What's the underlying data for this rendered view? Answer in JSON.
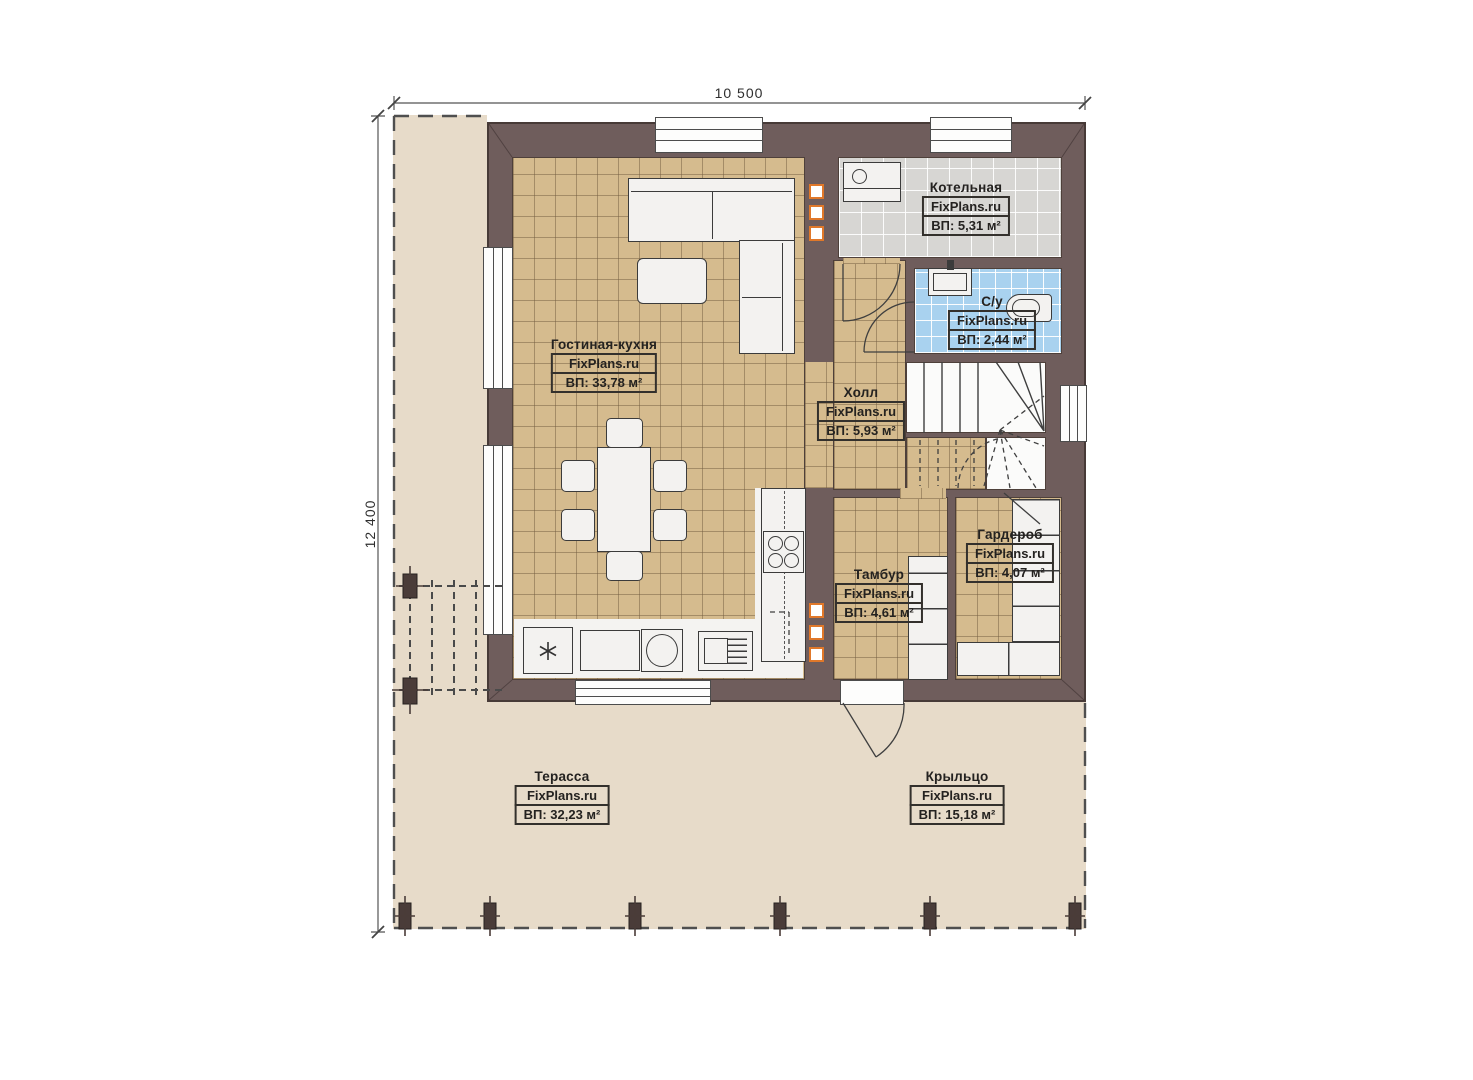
{
  "plan": {
    "dimension_top": "10 500",
    "dimension_left": "12 400",
    "brand": "FixPlans.ru",
    "rooms": [
      {
        "name": "Гостиная-кухня",
        "brand": "FixPlans.ru",
        "area": "ВП: 33,78 м²"
      },
      {
        "name": "Котельная",
        "brand": "FixPlans.ru",
        "area": "ВП: 5,31 м²"
      },
      {
        "name": "С/у",
        "brand": "FixPlans.ru",
        "area": "ВП: 2,44 м²"
      },
      {
        "name": "Холл",
        "brand": "FixPlans.ru",
        "area": "ВП: 5,93 м²"
      },
      {
        "name": "Гардероб",
        "brand": "FixPlans.ru",
        "area": "ВП: 4,07 м²"
      },
      {
        "name": "Тамбур",
        "brand": "FixPlans.ru",
        "area": "ВП: 4,61 м²"
      },
      {
        "name": "Терасса",
        "brand": "FixPlans.ru",
        "area": "ВП: 32,23 м²"
      },
      {
        "name": "Крыльцо",
        "brand": "FixPlans.ru",
        "area": "ВП: 15,18 м²"
      }
    ],
    "colors": {
      "wall": "#6f5d5c",
      "floor_tan": "#d5bb8e",
      "floor_gray": "#d7d6d3",
      "floor_blue": "#a9d2ef",
      "outdoor": "#e7dbc9",
      "marker_orange": "#e0782a"
    }
  }
}
